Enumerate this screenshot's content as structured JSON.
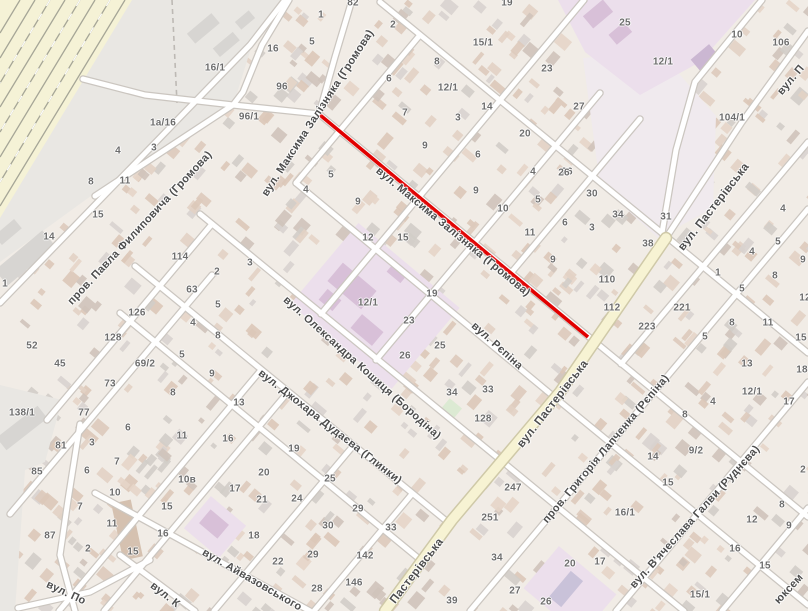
{
  "map": {
    "type": "street-map",
    "colors": {
      "background": "#f1ece6",
      "industrial_zone": "#e9e7e3",
      "railway_band": "#f5f2d6",
      "road_fill": "#ffffff",
      "main_road_fill": "#f7f3d3",
      "school_area": "#ecdfec",
      "route_highlight": "#e10000",
      "label_text": "#4d4d4d",
      "number_text": "#6d6d6d"
    },
    "route_highlight": {
      "x1": 320,
      "y1": 115,
      "x2": 588,
      "y2": 337
    },
    "boundary_dash": {
      "x1": 172,
      "y1": 0,
      "x2": 177,
      "y2": 103
    },
    "streets": [
      {
        "label": "вул. Максима Залізняка (Громова)",
        "x": 318,
        "y": 113,
        "rot": -57,
        "fs": 11
      },
      {
        "label": "вул. Максима Залізняка (Громова)",
        "x": 453,
        "y": 232,
        "rot": 39.5,
        "fs": 11
      },
      {
        "label": "пров. Павла Филиповича (Громова)",
        "x": 140,
        "y": 228,
        "rot": -47,
        "fs": 11
      },
      {
        "label": "вул. Олександра Кошиця (Бородіна)",
        "x": 362,
        "y": 368,
        "rot": 42,
        "fs": 11
      },
      {
        "label": "вул. Джохара Дудаєва (Глинки)",
        "x": 330,
        "y": 427,
        "rot": 38,
        "fs": 11
      },
      {
        "label": "вул. Рєпіна",
        "x": 497,
        "y": 346,
        "rot": 42,
        "fs": 11
      },
      {
        "label": "вул. Айвазовського",
        "x": 252,
        "y": 580,
        "rot": 30,
        "fs": 11
      },
      {
        "label": "вул. Пастерівська",
        "x": 714,
        "y": 207,
        "rot": -52,
        "fs": 11.5
      },
      {
        "label": "вул. Пастерівська",
        "x": 553,
        "y": 404,
        "rot": -52,
        "fs": 11.5
      },
      {
        "label": "Пастерівська",
        "x": 417,
        "y": 571,
        "rot": -52,
        "fs": 11.5
      },
      {
        "label": "пров. Григорія Лапченка (Рєпіна)",
        "x": 606,
        "y": 449,
        "rot": -50,
        "fs": 11
      },
      {
        "label": "вул. В'ячеслава Галви (Руднєва)",
        "x": 695,
        "y": 517,
        "rot": -48,
        "fs": 11
      },
      {
        "label": "вул. По",
        "x": 66,
        "y": 593,
        "rot": 25,
        "fs": 11
      },
      {
        "label": "вул. К",
        "x": 165,
        "y": 595,
        "rot": 38,
        "fs": 11
      },
      {
        "label": "юксем",
        "x": 789,
        "y": 589,
        "rot": -47,
        "fs": 11
      },
      {
        "label": "вул. П",
        "x": 791,
        "y": 80,
        "rot": -50,
        "fs": 11
      }
    ],
    "house_numbers": [
      {
        "n": "82",
        "x": 353,
        "y": 3
      },
      {
        "n": "1",
        "x": 321,
        "y": 15
      },
      {
        "n": "2",
        "x": 393,
        "y": 25
      },
      {
        "n": "5",
        "x": 312,
        "y": 42
      },
      {
        "n": "16",
        "x": 273,
        "y": 49
      },
      {
        "n": "96",
        "x": 282,
        "y": 87
      },
      {
        "n": "96/1",
        "x": 249,
        "y": 117
      },
      {
        "n": "16/1",
        "x": 215,
        "y": 68
      },
      {
        "n": "1а/16",
        "x": 163,
        "y": 123
      },
      {
        "n": "4",
        "x": 118,
        "y": 151
      },
      {
        "n": "3",
        "x": 154,
        "y": 148
      },
      {
        "n": "8",
        "x": 91,
        "y": 182
      },
      {
        "n": "11",
        "x": 125,
        "y": 181
      },
      {
        "n": "15",
        "x": 98,
        "y": 215
      },
      {
        "n": "14",
        "x": 49,
        "y": 237
      },
      {
        "n": "1",
        "x": 5,
        "y": 284
      },
      {
        "n": "114",
        "x": 180,
        "y": 257
      },
      {
        "n": "2",
        "x": 217,
        "y": 272
      },
      {
        "n": "3",
        "x": 250,
        "y": 263
      },
      {
        "n": "63",
        "x": 192,
        "y": 290
      },
      {
        "n": "5",
        "x": 218,
        "y": 305
      },
      {
        "n": "4",
        "x": 193,
        "y": 323
      },
      {
        "n": "8",
        "x": 218,
        "y": 336
      },
      {
        "n": "126",
        "x": 137,
        "y": 313
      },
      {
        "n": "128",
        "x": 113,
        "y": 338
      },
      {
        "n": "52",
        "x": 32,
        "y": 346
      },
      {
        "n": "45",
        "x": 60,
        "y": 364
      },
      {
        "n": "69/2",
        "x": 145,
        "y": 364
      },
      {
        "n": "73",
        "x": 110,
        "y": 384
      },
      {
        "n": "5",
        "x": 182,
        "y": 355
      },
      {
        "n": "9",
        "x": 212,
        "y": 374
      },
      {
        "n": "8",
        "x": 173,
        "y": 393
      },
      {
        "n": "138/1",
        "x": 22,
        "y": 413
      },
      {
        "n": "77",
        "x": 84,
        "y": 413
      },
      {
        "n": "81",
        "x": 61,
        "y": 446
      },
      {
        "n": "85",
        "x": 37,
        "y": 472
      },
      {
        "n": "87",
        "x": 50,
        "y": 536
      },
      {
        "n": "3",
        "x": 92,
        "y": 443
      },
      {
        "n": "6",
        "x": 128,
        "y": 428
      },
      {
        "n": "7",
        "x": 117,
        "y": 462
      },
      {
        "n": "6",
        "x": 87,
        "y": 471
      },
      {
        "n": "10",
        "x": 115,
        "y": 493
      },
      {
        "n": "7",
        "x": 80,
        "y": 507
      },
      {
        "n": "11",
        "x": 112,
        "y": 524
      },
      {
        "n": "2",
        "x": 88,
        "y": 549
      },
      {
        "n": "15",
        "x": 133,
        "y": 552
      },
      {
        "n": "11",
        "x": 182,
        "y": 436
      },
      {
        "n": "16",
        "x": 228,
        "y": 439
      },
      {
        "n": "10в",
        "x": 187,
        "y": 480
      },
      {
        "n": "15",
        "x": 167,
        "y": 507
      },
      {
        "n": "16",
        "x": 163,
        "y": 534
      },
      {
        "n": "17",
        "x": 235,
        "y": 489
      },
      {
        "n": "18",
        "x": 254,
        "y": 536
      },
      {
        "n": "13",
        "x": 239,
        "y": 403
      },
      {
        "n": "20",
        "x": 264,
        "y": 473
      },
      {
        "n": "21",
        "x": 262,
        "y": 500
      },
      {
        "n": "22",
        "x": 278,
        "y": 562
      },
      {
        "n": "19",
        "x": 294,
        "y": 449
      },
      {
        "n": "25",
        "x": 330,
        "y": 479
      },
      {
        "n": "24",
        "x": 297,
        "y": 499
      },
      {
        "n": "29",
        "x": 358,
        "y": 509
      },
      {
        "n": "30",
        "x": 328,
        "y": 526
      },
      {
        "n": "33",
        "x": 391,
        "y": 528
      },
      {
        "n": "29",
        "x": 313,
        "y": 555
      },
      {
        "n": "28",
        "x": 317,
        "y": 589
      },
      {
        "n": "142",
        "x": 365,
        "y": 556
      },
      {
        "n": "146",
        "x": 354,
        "y": 583
      },
      {
        "n": "39",
        "x": 452,
        "y": 601
      },
      {
        "n": "8",
        "x": 437,
        "y": 62
      },
      {
        "n": "6",
        "x": 389,
        "y": 79
      },
      {
        "n": "15/1",
        "x": 483,
        "y": 43
      },
      {
        "n": "12/1",
        "x": 448,
        "y": 88
      },
      {
        "n": "14",
        "x": 487,
        "y": 107
      },
      {
        "n": "3",
        "x": 458,
        "y": 118
      },
      {
        "n": "7",
        "x": 405,
        "y": 113
      },
      {
        "n": "9",
        "x": 425,
        "y": 146
      },
      {
        "n": "6",
        "x": 478,
        "y": 155
      },
      {
        "n": "20",
        "x": 525,
        "y": 134
      },
      {
        "n": "19",
        "x": 507,
        "y": 3
      },
      {
        "n": "5",
        "x": 331,
        "y": 175
      },
      {
        "n": "4",
        "x": 306,
        "y": 190
      },
      {
        "n": "9",
        "x": 358,
        "y": 202
      },
      {
        "n": "4",
        "x": 533,
        "y": 172
      },
      {
        "n": "26",
        "x": 567,
        "y": 172
      },
      {
        "n": "9",
        "x": 476,
        "y": 191
      },
      {
        "n": "5",
        "x": 538,
        "y": 200
      },
      {
        "n": "10",
        "x": 503,
        "y": 209
      },
      {
        "n": "30",
        "x": 592,
        "y": 194
      },
      {
        "n": "11",
        "x": 530,
        "y": 233
      },
      {
        "n": "6",
        "x": 565,
        "y": 223
      },
      {
        "n": "3",
        "x": 592,
        "y": 228
      },
      {
        "n": "9",
        "x": 553,
        "y": 260
      },
      {
        "n": "12",
        "x": 368,
        "y": 238
      },
      {
        "n": "15",
        "x": 403,
        "y": 238
      },
      {
        "n": "19",
        "x": 432,
        "y": 294
      },
      {
        "n": "23",
        "x": 409,
        "y": 321
      },
      {
        "n": "12/1",
        "x": 368,
        "y": 303
      },
      {
        "n": "25",
        "x": 440,
        "y": 346
      },
      {
        "n": "26",
        "x": 405,
        "y": 356
      },
      {
        "n": "34",
        "x": 452,
        "y": 393
      },
      {
        "n": "33",
        "x": 488,
        "y": 390
      },
      {
        "n": "128",
        "x": 483,
        "y": 419
      },
      {
        "n": "34",
        "x": 618,
        "y": 215
      },
      {
        "n": "31",
        "x": 666,
        "y": 217
      },
      {
        "n": "38",
        "x": 648,
        "y": 244
      },
      {
        "n": "110",
        "x": 607,
        "y": 280
      },
      {
        "n": "112",
        "x": 612,
        "y": 308
      },
      {
        "n": "221",
        "x": 682,
        "y": 308
      },
      {
        "n": "223",
        "x": 647,
        "y": 327
      },
      {
        "n": "25",
        "x": 625,
        "y": 23
      },
      {
        "n": "10",
        "x": 737,
        "y": 35
      },
      {
        "n": "106",
        "x": 781,
        "y": 43
      },
      {
        "n": "23",
        "x": 547,
        "y": 69
      },
      {
        "n": "27",
        "x": 579,
        "y": 107
      },
      {
        "n": "12/1",
        "x": 663,
        "y": 62
      },
      {
        "n": "104/1",
        "x": 732,
        "y": 118
      },
      {
        "n": "26",
        "x": 564,
        "y": 173
      },
      {
        "n": "1",
        "x": 718,
        "y": 273
      },
      {
        "n": "5",
        "x": 742,
        "y": 289
      },
      {
        "n": "4",
        "x": 752,
        "y": 252
      },
      {
        "n": "5",
        "x": 778,
        "y": 242
      },
      {
        "n": "8",
        "x": 775,
        "y": 276
      },
      {
        "n": "9",
        "x": 803,
        "y": 260
      },
      {
        "n": "4",
        "x": 783,
        "y": 209
      },
      {
        "n": "8",
        "x": 732,
        "y": 323
      },
      {
        "n": "11",
        "x": 768,
        "y": 323
      },
      {
        "n": "12",
        "x": 805,
        "y": 298
      },
      {
        "n": "15",
        "x": 801,
        "y": 338
      },
      {
        "n": "5",
        "x": 705,
        "y": 337
      },
      {
        "n": "13",
        "x": 747,
        "y": 364
      },
      {
        "n": "18",
        "x": 802,
        "y": 370
      },
      {
        "n": "12/1",
        "x": 752,
        "y": 392
      },
      {
        "n": "4",
        "x": 713,
        "y": 402
      },
      {
        "n": "17",
        "x": 789,
        "y": 402
      },
      {
        "n": "2",
        "x": 803,
        "y": 470
      },
      {
        "n": "8",
        "x": 782,
        "y": 505
      },
      {
        "n": "12",
        "x": 752,
        "y": 520
      },
      {
        "n": "9",
        "x": 789,
        "y": 526
      },
      {
        "n": "16",
        "x": 735,
        "y": 549
      },
      {
        "n": "15",
        "x": 765,
        "y": 566
      },
      {
        "n": "15/1",
        "x": 700,
        "y": 595
      },
      {
        "n": "247",
        "x": 513,
        "y": 488
      },
      {
        "n": "251",
        "x": 490,
        "y": 518
      },
      {
        "n": "34",
        "x": 497,
        "y": 558
      },
      {
        "n": "27",
        "x": 515,
        "y": 591
      },
      {
        "n": "26",
        "x": 546,
        "y": 602
      },
      {
        "n": "8",
        "x": 685,
        "y": 415
      },
      {
        "n": "14",
        "x": 653,
        "y": 457
      },
      {
        "n": "9/2",
        "x": 696,
        "y": 451
      },
      {
        "n": "15",
        "x": 668,
        "y": 483
      },
      {
        "n": "16/1",
        "x": 625,
        "y": 513
      },
      {
        "n": "20",
        "x": 570,
        "y": 564
      },
      {
        "n": "17",
        "x": 600,
        "y": 562
      }
    ]
  }
}
